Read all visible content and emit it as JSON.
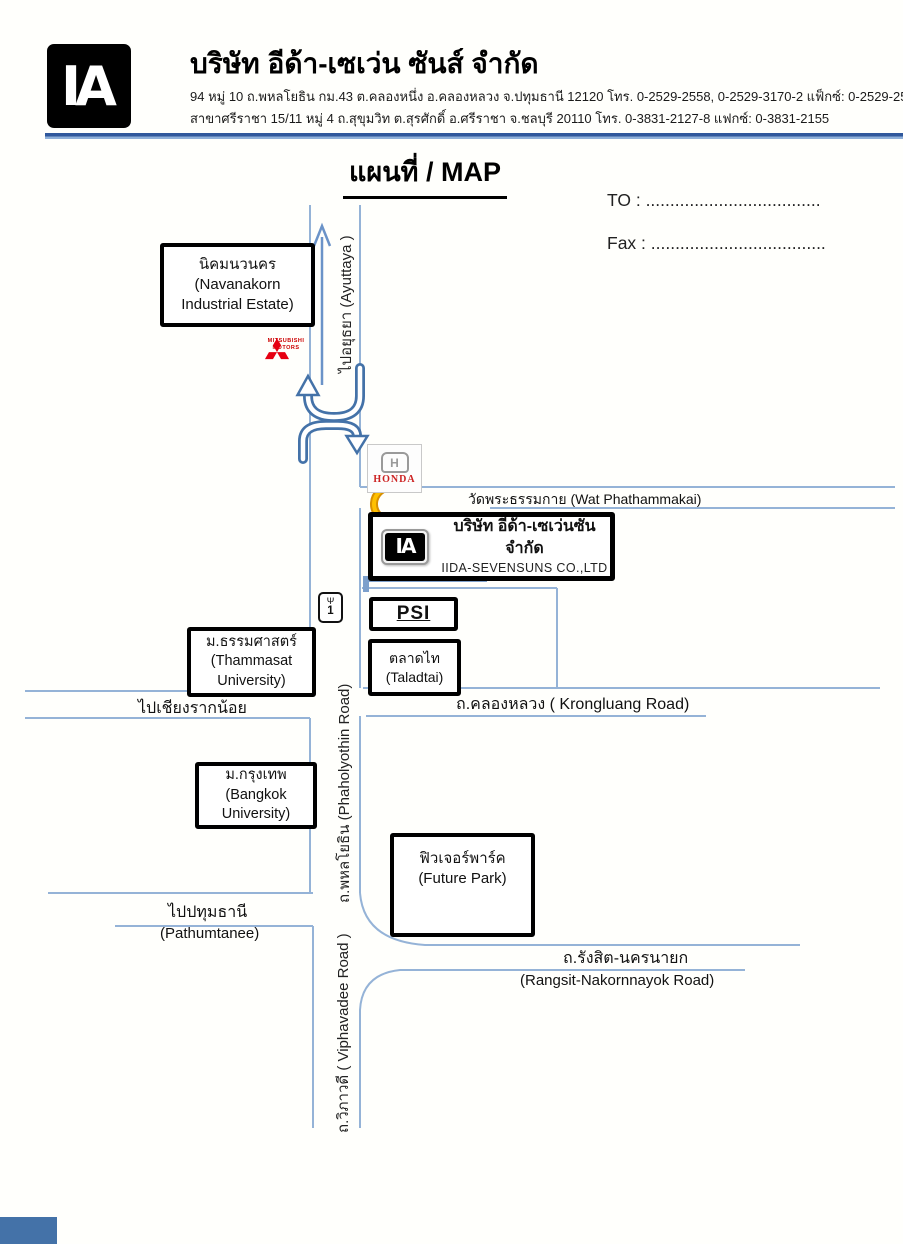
{
  "header": {
    "logo": "IA",
    "company_name_th": "บริษัท อีด้า-เซเว่น ซันส์ จำกัด",
    "address_line1": "94 หมู่ 10 ถ.พหลโยธิน กม.43 ต.คลองหนึ่ง อ.คลองหลวง จ.ปทุมธานี 12120 โทร. 0-2529-2558, 0-2529-3170-2 แฟ็กซ์: 0-2529-2557, 0-2529-4593",
    "address_line2": "สาขาศรีราชา 15/11 หมู่ 4 ถ.สุขุมวิท ต.สุรศักดิ์ อ.ศรีราชา จ.ชลบุรี 20110 โทร. 0-3831-2127-8 แฟกซ์: 0-3831-2155"
  },
  "title": "แผนที่ / MAP",
  "recipient": {
    "to": "TO : ....................................",
    "fax": "Fax : ...................................."
  },
  "map": {
    "roads": {
      "ayuttaya": "ไปอยุธยา (Ayuttaya )",
      "phaholyothin": "ถ.พหลโยธิน (Phaholyothin Road)",
      "viphavadee": "ถ.วิภาวดี ( Viphavadee Road )",
      "wat_phathammakai": "วัดพระธรรมกาย (Wat Phathammakai)",
      "chiang_rak_noi": "ไปเชียงรากน้อย",
      "krongluang": "ถ.คลองหลวง ( Krongluang Road)",
      "pathumtanee_th": "ไปปทุมธานี",
      "pathumtanee_en": "(Pathumtanee)",
      "rangsit_th": "ถ.รังสิต-นครนายก",
      "rangsit_en": "(Rangsit-Nakornnayok Road)"
    },
    "places": {
      "navanakorn": {
        "l1": "นิคมนวนคร",
        "l2": "(Navanakorn",
        "l3": "Industrial Estate)"
      },
      "thammasat": {
        "l1": "ม.ธรรมศาสตร์",
        "l2": "(Thammasat",
        "l3": "University)"
      },
      "bangkok_university": {
        "l1": "ม.กรุงเทพ",
        "l2": "(Bangkok",
        "l3": "University)"
      },
      "taladtai": {
        "l1": "ตลาดไท",
        "l2": "(Taladtai)"
      },
      "psi": {
        "l1": "PSI"
      },
      "future_park": {
        "l1": "ฟิวเจอร์พาร์ค",
        "l2": "(Future Park)"
      },
      "company": {
        "logo": "IA",
        "name_th": "บริษัท อีด้า-เซเว่นซัน จำกัด",
        "name_en": "IIDA-SEVENSUNS CO.,LTD"
      }
    },
    "landmarks": {
      "mitsubishi_l1": "MITSUBISHI",
      "mitsubishi_l2": "MOTORS",
      "honda_letter": "H",
      "honda_name": "HONDA",
      "highway_symbol": "Ψ",
      "highway_no": "1"
    }
  },
  "colors": {
    "road_blue": "#95b3d7",
    "uturn_arrow_blue": "#4472a8",
    "route_arrow_blue": "#7da0cc",
    "uturn_yellow": "#ffc000",
    "brand_red": "#cc0000",
    "rule_blue": "#30589c"
  }
}
